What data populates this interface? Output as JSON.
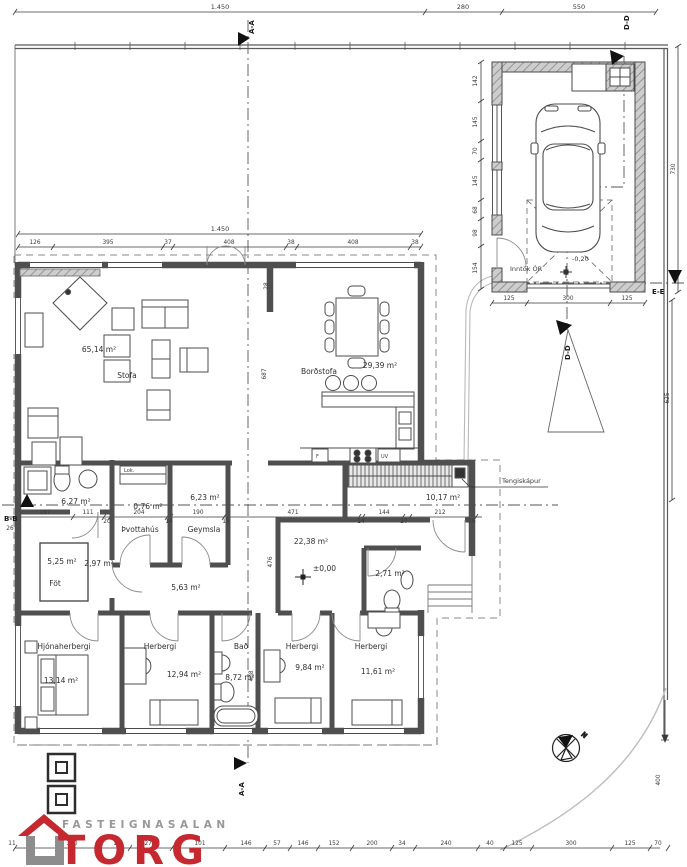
{
  "document": {
    "type": "architectural floor plan"
  },
  "colors": {
    "wall": "#4f4f4f",
    "line": "#3a3a3a",
    "accent_red": "#c5282f",
    "logo_gray": "#989898"
  },
  "labels": {
    "stofa_name": "Stofa",
    "stofa_area": "65,14 m²",
    "bord_name": "Borðstofa",
    "bord_area": "29,39 m²",
    "bath1_area": "6,27 m²",
    "closet_tag": "Lok.",
    "closet_area": "0,76 m²",
    "g623_area": "6,23 m²",
    "forstofa_area": "10,17 m²",
    "fot_name": "Föt",
    "fot_area": "5,25 m²",
    "g297_area": "2,97 m²",
    "thvotta_name": "Þvottahús",
    "geymsla_name": "Geymsla",
    "gang_area": "5,63 m²",
    "hall_area": "22,38 m²",
    "hall_level": "±0,00",
    "wc_area": "2,71 m²",
    "hjona_name": "Hjónaherbergi",
    "hjona_area": "13,14 m²",
    "herb1_name": "Herbergi",
    "herb1_area": "12,94 m²",
    "bad_name": "Bað",
    "bad_area": "8,72 m²",
    "herb2_name": "Herbergi",
    "herb2_area": "9,84 m²",
    "herb3_name": "Herbergi",
    "herb3_area": "11,61 m²",
    "f": "F",
    "uv": "UV",
    "inntak": "Inntök ÓR",
    "garage_level": "-0,20",
    "tengiskapur": "Tengiskápur",
    "north": "N"
  },
  "sections": {
    "aa": "A-A",
    "bb": "B-B",
    "dd": "D-D",
    "ee": "E-E"
  },
  "dims": {
    "top_total": "1.450",
    "top_280": "280",
    "top_550": "550",
    "house_top_total": "1.450",
    "house_top": [
      "126",
      "395",
      "37",
      "408",
      "38",
      "408",
      "38"
    ],
    "mid": [
      "197",
      "111",
      "20",
      "204",
      "14",
      "190",
      "15",
      "471",
      "14",
      "144",
      "27",
      "212",
      "26"
    ],
    "mid_left": "26",
    "v28": "28",
    "v687": "687",
    "v476": "476",
    "v408": "408",
    "garage_left": [
      "142",
      "145",
      "70",
      "145",
      "68",
      "98",
      "154"
    ],
    "garage_bottom": [
      "125",
      "300",
      "125"
    ],
    "right_730": "730",
    "right_625": "625",
    "right_400": "400",
    "bottom": [
      "11",
      "300",
      "1",
      "275",
      "101",
      "146",
      "57",
      "146",
      "152",
      "200",
      "34",
      "240",
      "40",
      "125",
      "300",
      "125",
      "70"
    ]
  },
  "logo": {
    "line1": "FASTEIGNASALAN",
    "line2": "TORG"
  }
}
